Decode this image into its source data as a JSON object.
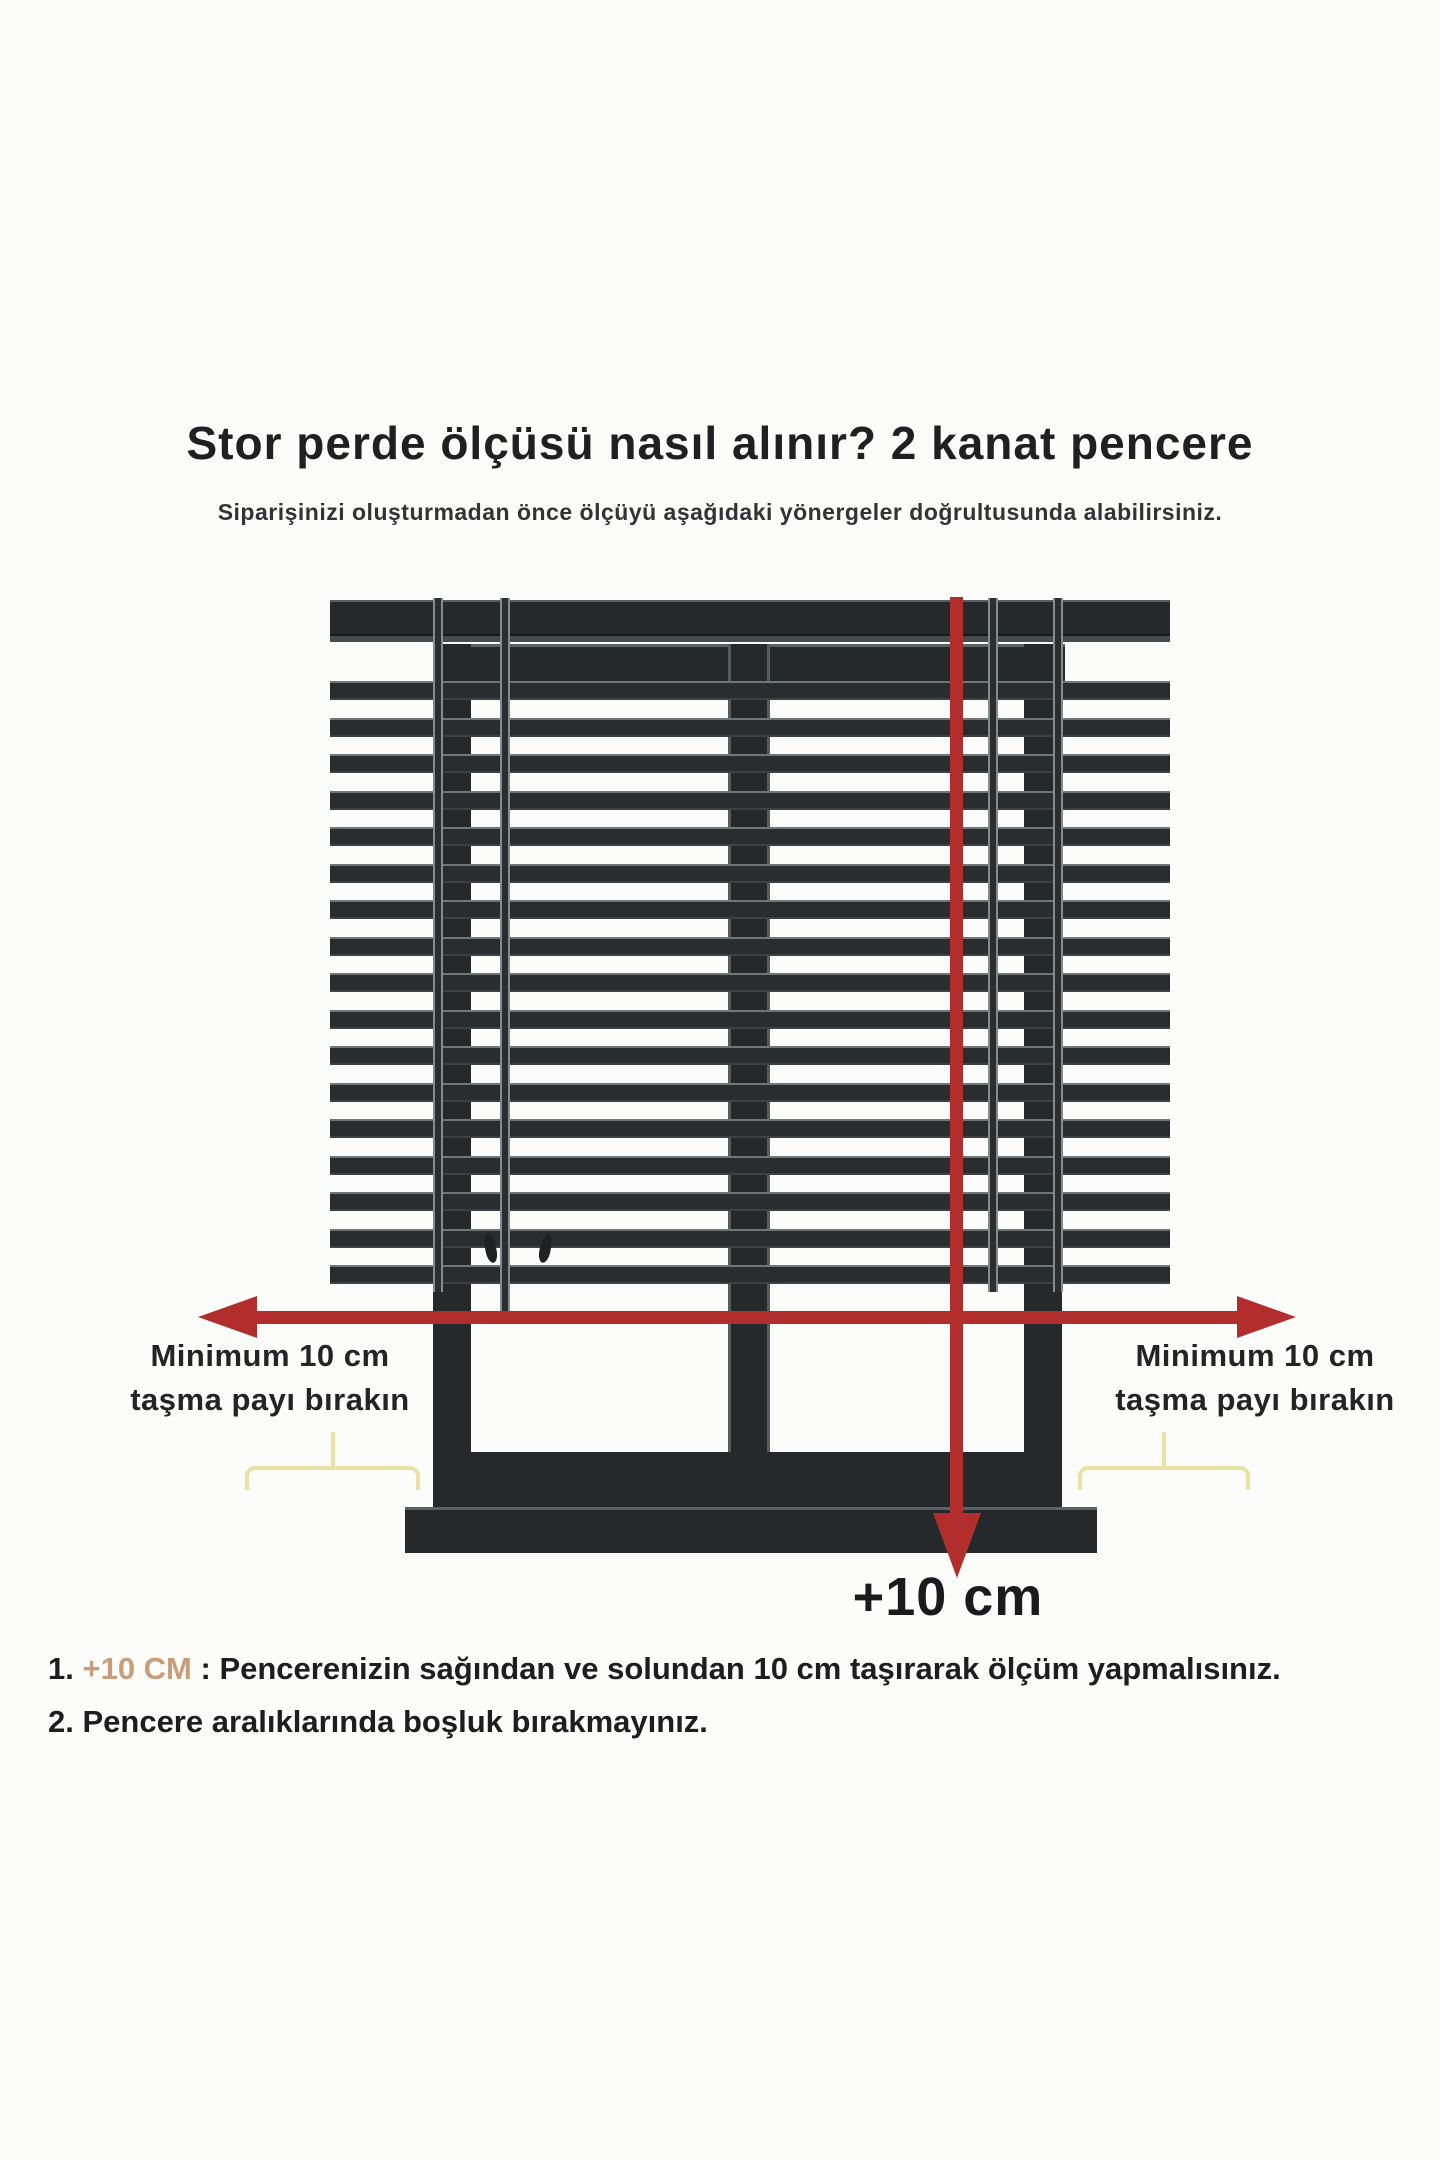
{
  "title": "Stor perde ölçüsü nasıl alınır? 2 kanat pencere",
  "subtitle": "Siparişinizi oluşturmadan önce ölçüyü aşağıdaki yönergeler doğrultusunda alabilirsiniz.",
  "diagram": {
    "window_type": "2 kanat pencere",
    "pane_count": 2,
    "left_overhang_label": {
      "line1": "Minimum 10 cm",
      "line2": "taşma payı bırakın"
    },
    "right_overhang_label": {
      "line1": "Minimum 10 cm",
      "line2": "taşma payı bırakın"
    },
    "bottom_arrow_label": "+10 cm",
    "blind": {
      "slat_count": 17,
      "slat_start_y": 681,
      "slat_period": 36.5,
      "slat_height": 19,
      "left": 330,
      "width": 840,
      "cords": [
        {
          "x": 433,
          "bottom": 1292
        },
        {
          "x": 500,
          "bottom": 1316
        },
        {
          "x": 988,
          "bottom": 1292
        },
        {
          "x": 1053,
          "bottom": 1292
        }
      ],
      "tassels": [
        {
          "x": 485,
          "y": 1233
        },
        {
          "x": 540,
          "y": 1233
        }
      ]
    }
  },
  "notes": [
    {
      "number": "1.",
      "highlight": " +10 CM",
      "rest": " : Pencerenizin sağından ve solundan 10 cm taşırarak ölçüm yapmalısınız."
    },
    {
      "number": "2.",
      "highlight": "",
      "rest": " Pencere aralıklarında boşluk bırakmayınız."
    }
  ],
  "colors": {
    "arrow_red": "#b12e2d",
    "frame_dark": "#26292b",
    "slat_dark": "#2a2d2f",
    "slat_edge": "#6f7879",
    "brace_yellow": "#e9e2a4",
    "note_highlight": "#c79d7a",
    "text_dark": "#1d1d1f"
  }
}
